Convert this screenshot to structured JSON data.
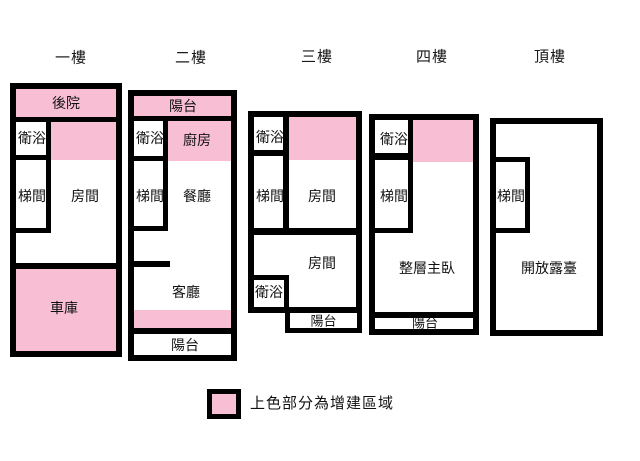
{
  "colors": {
    "pink": "#F8BED3",
    "wall": "#000000",
    "background": "#FFFFFF"
  },
  "legend": {
    "text": "上色部分為增建區域",
    "swatch": "addition-area-swatch"
  },
  "plans": [
    {
      "name": "floor-1",
      "title": "一樓",
      "title_center": {
        "x": 71,
        "y": 57
      },
      "frame": {
        "x": 10,
        "y": 83,
        "w": 112,
        "h": 274
      },
      "fills": [
        {
          "name": "backyard-addition-area",
          "x": 0,
          "y": 0,
          "w": 100,
          "h": 28
        },
        {
          "name": "addition-area",
          "x": 35,
          "y": 33,
          "w": 65,
          "h": 38
        },
        {
          "name": "garage-addition-area",
          "x": 0,
          "y": 180,
          "w": 100,
          "h": 82
        }
      ],
      "walls": [
        {
          "x": 0,
          "y": 28,
          "w": 100,
          "h": 5
        },
        {
          "x": 30,
          "y": 33,
          "w": 5,
          "h": 111
        },
        {
          "x": 0,
          "y": 66,
          "w": 35,
          "h": 5
        },
        {
          "x": 0,
          "y": 139,
          "w": 35,
          "h": 5
        },
        {
          "x": 0,
          "y": 174,
          "w": 100,
          "h": 6
        }
      ],
      "labels": [
        {
          "name": "backyard",
          "text": "後院",
          "cx": 50,
          "cy": 14
        },
        {
          "name": "bathroom",
          "text": "衛浴",
          "cx": 16,
          "cy": 49
        },
        {
          "name": "stairwell",
          "text": "梯間",
          "cx": 16,
          "cy": 107
        },
        {
          "name": "room",
          "text": "房間",
          "cx": 69,
          "cy": 107
        },
        {
          "name": "garage",
          "text": "車庫",
          "cx": 48,
          "cy": 219
        }
      ]
    },
    {
      "name": "floor-2",
      "title": "二樓",
      "title_center": {
        "x": 191,
        "y": 57
      },
      "frame": {
        "x": 128,
        "y": 90,
        "w": 109,
        "h": 271
      },
      "fills": [
        {
          "name": "balcony-addition-area",
          "x": 0,
          "y": 0,
          "w": 97,
          "h": 20
        },
        {
          "name": "kitchen-addition-area",
          "x": 34,
          "y": 25,
          "w": 63,
          "h": 40
        },
        {
          "name": "addition-strip-area",
          "x": 0,
          "y": 214,
          "w": 97,
          "h": 18
        }
      ],
      "walls": [
        {
          "x": 0,
          "y": 20,
          "w": 97,
          "h": 5
        },
        {
          "x": 29,
          "y": 25,
          "w": 5,
          "h": 110
        },
        {
          "x": 0,
          "y": 60,
          "w": 34,
          "h": 5
        },
        {
          "x": 0,
          "y": 130,
          "w": 34,
          "h": 5
        },
        {
          "x": 0,
          "y": 165,
          "w": 36,
          "h": 6
        },
        {
          "x": 0,
          "y": 232,
          "w": 97,
          "h": 6
        }
      ],
      "labels": [
        {
          "name": "balcony-top",
          "text": "陽台",
          "cx": 49,
          "cy": 10
        },
        {
          "name": "bathroom",
          "text": "衛浴",
          "cx": 16,
          "cy": 42
        },
        {
          "name": "kitchen",
          "text": "廚房",
          "cx": 63,
          "cy": 44
        },
        {
          "name": "stairwell",
          "text": "梯間",
          "cx": 16,
          "cy": 100
        },
        {
          "name": "dining-room",
          "text": "餐廳",
          "cx": 63,
          "cy": 100
        },
        {
          "name": "living-room",
          "text": "客廳",
          "cx": 52,
          "cy": 196
        },
        {
          "name": "balcony-bottom",
          "text": "陽台",
          "cx": 51,
          "cy": 249
        }
      ]
    },
    {
      "name": "floor-3",
      "title": "三樓",
      "title_center": {
        "x": 317,
        "y": 56
      },
      "frame": {
        "x": 248,
        "y": 111,
        "w": 114,
        "h": 202
      },
      "fills": [
        {
          "name": "addition-area",
          "x": 35,
          "y": 0,
          "w": 67,
          "h": 43
        }
      ],
      "walls": [
        {
          "x": 29,
          "y": 0,
          "w": 6,
          "h": 111
        },
        {
          "x": 0,
          "y": 33,
          "w": 35,
          "h": 6
        },
        {
          "x": 0,
          "y": 111,
          "w": 102,
          "h": 7
        },
        {
          "x": 0,
          "y": 158,
          "w": 35,
          "h": 5
        },
        {
          "x": 30,
          "y": 158,
          "w": 5,
          "h": 32
        }
      ],
      "labels": [
        {
          "name": "bathroom-upper",
          "text": "衛浴",
          "cx": 16,
          "cy": 20
        },
        {
          "name": "stairwell",
          "text": "梯間",
          "cx": 16,
          "cy": 79
        },
        {
          "name": "room-upper",
          "text": "房間",
          "cx": 68,
          "cy": 79
        },
        {
          "name": "room-lower",
          "text": "房間",
          "cx": 68,
          "cy": 146
        },
        {
          "name": "bathroom-lower",
          "text": "衛浴",
          "cx": 15,
          "cy": 175
        }
      ]
    },
    {
      "name": "floor-4",
      "title": "四樓",
      "title_center": {
        "x": 432,
        "y": 56
      },
      "frame": {
        "x": 369,
        "y": 114,
        "w": 110,
        "h": 221
      },
      "fills": [
        {
          "name": "addition-area",
          "x": 38,
          "y": 0,
          "w": 60,
          "h": 42
        }
      ],
      "walls": [
        {
          "x": 33,
          "y": 0,
          "w": 5,
          "h": 113
        },
        {
          "x": 0,
          "y": 33,
          "w": 38,
          "h": 7
        },
        {
          "x": 0,
          "y": 108,
          "w": 38,
          "h": 5
        },
        {
          "x": 0,
          "y": 192,
          "w": 98,
          "h": 6
        }
      ],
      "labels": [
        {
          "name": "bathroom",
          "text": "衛浴",
          "cx": 19,
          "cy": 19
        },
        {
          "name": "stairwell",
          "text": "梯間",
          "cx": 19,
          "cy": 76
        },
        {
          "name": "master-bedroom",
          "text": "整層主臥",
          "cx": 52,
          "cy": 148
        },
        {
          "name": "balcony",
          "text": "陽台",
          "cx": 50,
          "cy": 203,
          "fs": 13
        }
      ]
    },
    {
      "name": "floor-top",
      "title": "頂樓",
      "title_center": {
        "x": 550,
        "y": 56
      },
      "frame": {
        "x": 490,
        "y": 118,
        "w": 113,
        "h": 218
      },
      "fills": [],
      "walls": [
        {
          "x": 0,
          "y": 33,
          "w": 34,
          "h": 5
        },
        {
          "x": 29,
          "y": 33,
          "w": 5,
          "h": 76
        },
        {
          "x": 0,
          "y": 104,
          "w": 34,
          "h": 5
        }
      ],
      "labels": [
        {
          "name": "stairwell",
          "text": "梯間",
          "cx": 15,
          "cy": 72
        },
        {
          "name": "open-terrace",
          "text": "開放露臺",
          "cx": 53,
          "cy": 144
        }
      ]
    }
  ],
  "annexes": [
    {
      "name": "floor-3-balcony-annex",
      "x": 285,
      "y": 313,
      "w": 77,
      "h": 20,
      "label": {
        "name": "balcony",
        "text": "陽台",
        "fs": 13
      }
    }
  ]
}
